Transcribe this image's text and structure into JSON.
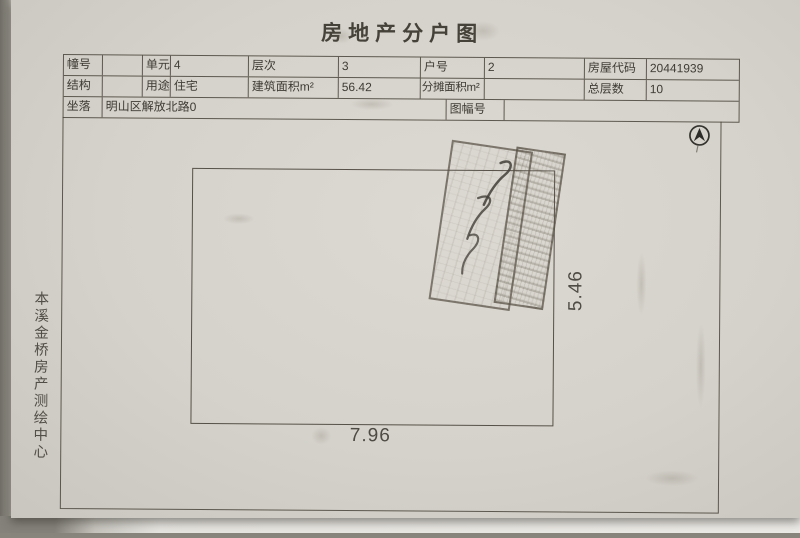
{
  "title": "房地产分户图",
  "info_table": {
    "rows": [
      {
        "cells": [
          {
            "label": "幢号",
            "value": ""
          },
          {
            "label": "单元",
            "value": "4"
          },
          {
            "label": "层次",
            "value": "3"
          },
          {
            "label": "户号",
            "value": "2"
          },
          {
            "label": "房屋代码",
            "value": "20441939"
          }
        ]
      },
      {
        "cells": [
          {
            "label": "结构",
            "value": ""
          },
          {
            "label": "用途",
            "value": "住宅"
          },
          {
            "label": "建筑面积m²",
            "value": "56.42"
          },
          {
            "label": "分摊面积m²",
            "value": ""
          },
          {
            "label": "总层数",
            "value": "10"
          }
        ]
      },
      {
        "cells": [
          {
            "label": "坐落",
            "value": "明山区解放北路0"
          },
          {
            "label": "图幅号",
            "value": ""
          }
        ]
      }
    ]
  },
  "plan": {
    "bottom_dimension": "7.96",
    "right_dimension": "5.46"
  },
  "side_caption": "本溪金桥房产测绘中心",
  "icons": {
    "compass": "north-arrow"
  },
  "colors": {
    "paper": "#d6d3cc",
    "ink": "#3e3b34",
    "table_line": "#484339",
    "stamp_border": "#58513f"
  }
}
